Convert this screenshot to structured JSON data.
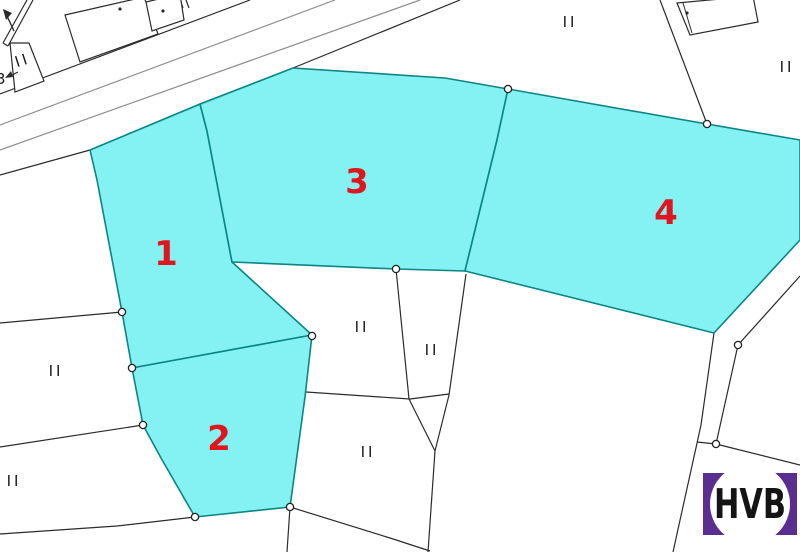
{
  "map": {
    "width": 800,
    "height": 552,
    "background": "#ffffff",
    "colors": {
      "boundary_line": "#2b2b2b",
      "road_inner_line": "#8e8e8e",
      "highlight_fill": "#7df0f1",
      "highlight_border": "#0c8585",
      "parcel_number_red": "#e1151d",
      "marker_text": "#1a1a1a",
      "vertex_fill": "#ffffff",
      "vertex_stroke": "#222222"
    },
    "highlighted_parcels": [
      {
        "number": "1",
        "label_pos": [
          166,
          265
        ],
        "points": [
          [
            90,
            150
          ],
          [
            200,
            104
          ],
          [
            207,
            131
          ],
          [
            232,
            262
          ],
          [
            312,
            335
          ],
          [
            132,
            368
          ],
          [
            122,
            312
          ],
          [
            97,
            180
          ]
        ]
      },
      {
        "number": "2",
        "label_pos": [
          219,
          450
        ],
        "points": [
          [
            132,
            368
          ],
          [
            312,
            335
          ],
          [
            305,
            397
          ],
          [
            290,
            507
          ],
          [
            195,
            517
          ],
          [
            161,
            458
          ],
          [
            143,
            425
          ]
        ]
      },
      {
        "number": "3",
        "label_pos": [
          357,
          193
        ],
        "points": [
          [
            293,
            68
          ],
          [
            445,
            78
          ],
          [
            508,
            89
          ],
          [
            497,
            140
          ],
          [
            465,
            271
          ],
          [
            396,
            269
          ],
          [
            232,
            262
          ],
          [
            207,
            131
          ],
          [
            200,
            104
          ]
        ]
      },
      {
        "number": "4",
        "label_pos": [
          666,
          224
        ],
        "points": [
          [
            508,
            89
          ],
          [
            707,
            124
          ],
          [
            800,
            140
          ],
          [
            800,
            240
          ],
          [
            714,
            333
          ],
          [
            465,
            271
          ],
          [
            497,
            140
          ]
        ]
      }
    ],
    "roads": [
      {
        "type": "boundary",
        "points": [
          [
            0,
            94
          ],
          [
            250,
            0
          ]
        ]
      },
      {
        "type": "inner",
        "points": [
          [
            0,
            125
          ],
          [
            335,
            0
          ]
        ]
      },
      {
        "type": "inner",
        "points": [
          [
            0,
            150
          ],
          [
            420,
            0
          ]
        ]
      },
      {
        "type": "boundary",
        "points": [
          [
            293,
            68
          ],
          [
            460,
            0
          ]
        ]
      },
      {
        "type": "boundary",
        "points": [
          [
            27,
            0
          ],
          [
            3,
            43
          ]
        ]
      },
      {
        "type": "boundary",
        "points": [
          [
            33,
            0
          ],
          [
            8,
            46
          ]
        ]
      },
      {
        "type": "boundary",
        "points": [
          [
            3,
            43
          ],
          [
            8,
            46
          ]
        ]
      }
    ],
    "boundaries": [
      {
        "points": [
          [
            0,
            175
          ],
          [
            90,
            150
          ],
          [
            293,
            68
          ]
        ]
      },
      {
        "points": [
          [
            0,
            323
          ],
          [
            122,
            312
          ]
        ]
      },
      {
        "points": [
          [
            0,
            447
          ],
          [
            143,
            425
          ]
        ]
      },
      {
        "points": [
          [
            0,
            534
          ],
          [
            117,
            526
          ],
          [
            195,
            517
          ]
        ]
      },
      {
        "points": [
          [
            287,
            552
          ],
          [
            290,
            507
          ]
        ]
      },
      {
        "points": [
          [
            290,
            507
          ],
          [
            390,
            538
          ],
          [
            430,
            551
          ]
        ]
      },
      {
        "points": [
          [
            306,
            392
          ],
          [
            410,
            399
          ],
          [
            449,
            394
          ]
        ]
      },
      {
        "points": [
          [
            396,
            269
          ],
          [
            409,
            399
          ],
          [
            435,
            451
          ]
        ]
      },
      {
        "points": [
          [
            466,
            274
          ],
          [
            449,
            395
          ],
          [
            435,
            451
          ]
        ]
      },
      {
        "points": [
          [
            435,
            451
          ],
          [
            428,
            552
          ]
        ]
      },
      {
        "points": [
          [
            660,
            0
          ],
          [
            707,
            124
          ]
        ]
      },
      {
        "points": [
          [
            800,
            276
          ],
          [
            738,
            345
          ]
        ]
      },
      {
        "points": [
          [
            738,
            345
          ],
          [
            716,
            444
          ]
        ]
      },
      {
        "points": [
          [
            697,
            442
          ],
          [
            716,
            444
          ],
          [
            800,
            465
          ]
        ]
      },
      {
        "points": [
          [
            714,
            333
          ],
          [
            701,
            425
          ],
          [
            673,
            552
          ]
        ]
      },
      {
        "points": [
          [
            180,
            0
          ],
          [
            183,
            8
          ]
        ]
      },
      {
        "points": [
          [
            186,
            0
          ],
          [
            189,
            8
          ]
        ]
      }
    ],
    "buildings": [
      {
        "points": [
          [
            65,
            15
          ],
          [
            144,
            -3
          ],
          [
            158,
            34
          ],
          [
            80,
            62
          ]
        ],
        "dot": [
          120,
          9
        ]
      },
      {
        "points": [
          [
            146,
            2
          ],
          [
            180,
            -6
          ],
          [
            184,
            20
          ],
          [
            152,
            31
          ]
        ],
        "dot": [
          163,
          11
        ]
      },
      {
        "points": [
          [
            677,
            3
          ],
          [
            753,
            -4
          ],
          [
            758,
            22
          ],
          [
            690,
            35
          ]
        ],
        "dot": [
          687,
          13
        ],
        "inner_line": [
          [
            683,
            3
          ],
          [
            692,
            33
          ]
        ]
      },
      {
        "points": [
          [
            10,
            43
          ],
          [
            29,
            43
          ],
          [
            44,
            81
          ],
          [
            15,
            92
          ]
        ]
      }
    ],
    "vertex_markers": [
      [
        122,
        312
      ],
      [
        132,
        368
      ],
      [
        143,
        425
      ],
      [
        195,
        517
      ],
      [
        290,
        507
      ],
      [
        312,
        336
      ],
      [
        396,
        269
      ],
      [
        508,
        89
      ],
      [
        707,
        124
      ],
      [
        738,
        345
      ],
      [
        716,
        444
      ]
    ],
    "zone_marker_text": "II",
    "zone_markers": [
      {
        "x": 24,
        "y": 65,
        "rotate": -18
      },
      {
        "x": 570,
        "y": 27,
        "rotate": 0
      },
      {
        "x": 787,
        "y": 72,
        "rotate": 0
      },
      {
        "x": 56,
        "y": 376,
        "rotate": 0
      },
      {
        "x": 14,
        "y": 486,
        "rotate": 0
      },
      {
        "x": 362,
        "y": 332,
        "rotate": 0
      },
      {
        "x": 432,
        "y": 355,
        "rotate": 0
      },
      {
        "x": 368,
        "y": 457,
        "rotate": 0
      }
    ],
    "north_arrow": {
      "shaft": [
        [
          14,
          31
        ],
        [
          7,
          16
        ]
      ],
      "head": [
        [
          3,
          9
        ],
        [
          12,
          13
        ],
        [
          6,
          20
        ]
      ]
    },
    "edge_annotation": {
      "text": "3",
      "pos": [
        -4,
        84
      ],
      "arrow_line": [
        [
          8,
          77
        ],
        [
          18,
          72
        ]
      ],
      "arrow_head": [
        [
          5,
          78
        ],
        [
          11,
          71
        ],
        [
          13,
          77
        ]
      ]
    },
    "logo": {
      "text": "HVB",
      "x": 703,
      "y": 473,
      "width": 94,
      "height": 62,
      "bg": "#5c2d91",
      "circle_color": "#ffffff",
      "circle_r": 40,
      "text_color": "#141414"
    }
  }
}
